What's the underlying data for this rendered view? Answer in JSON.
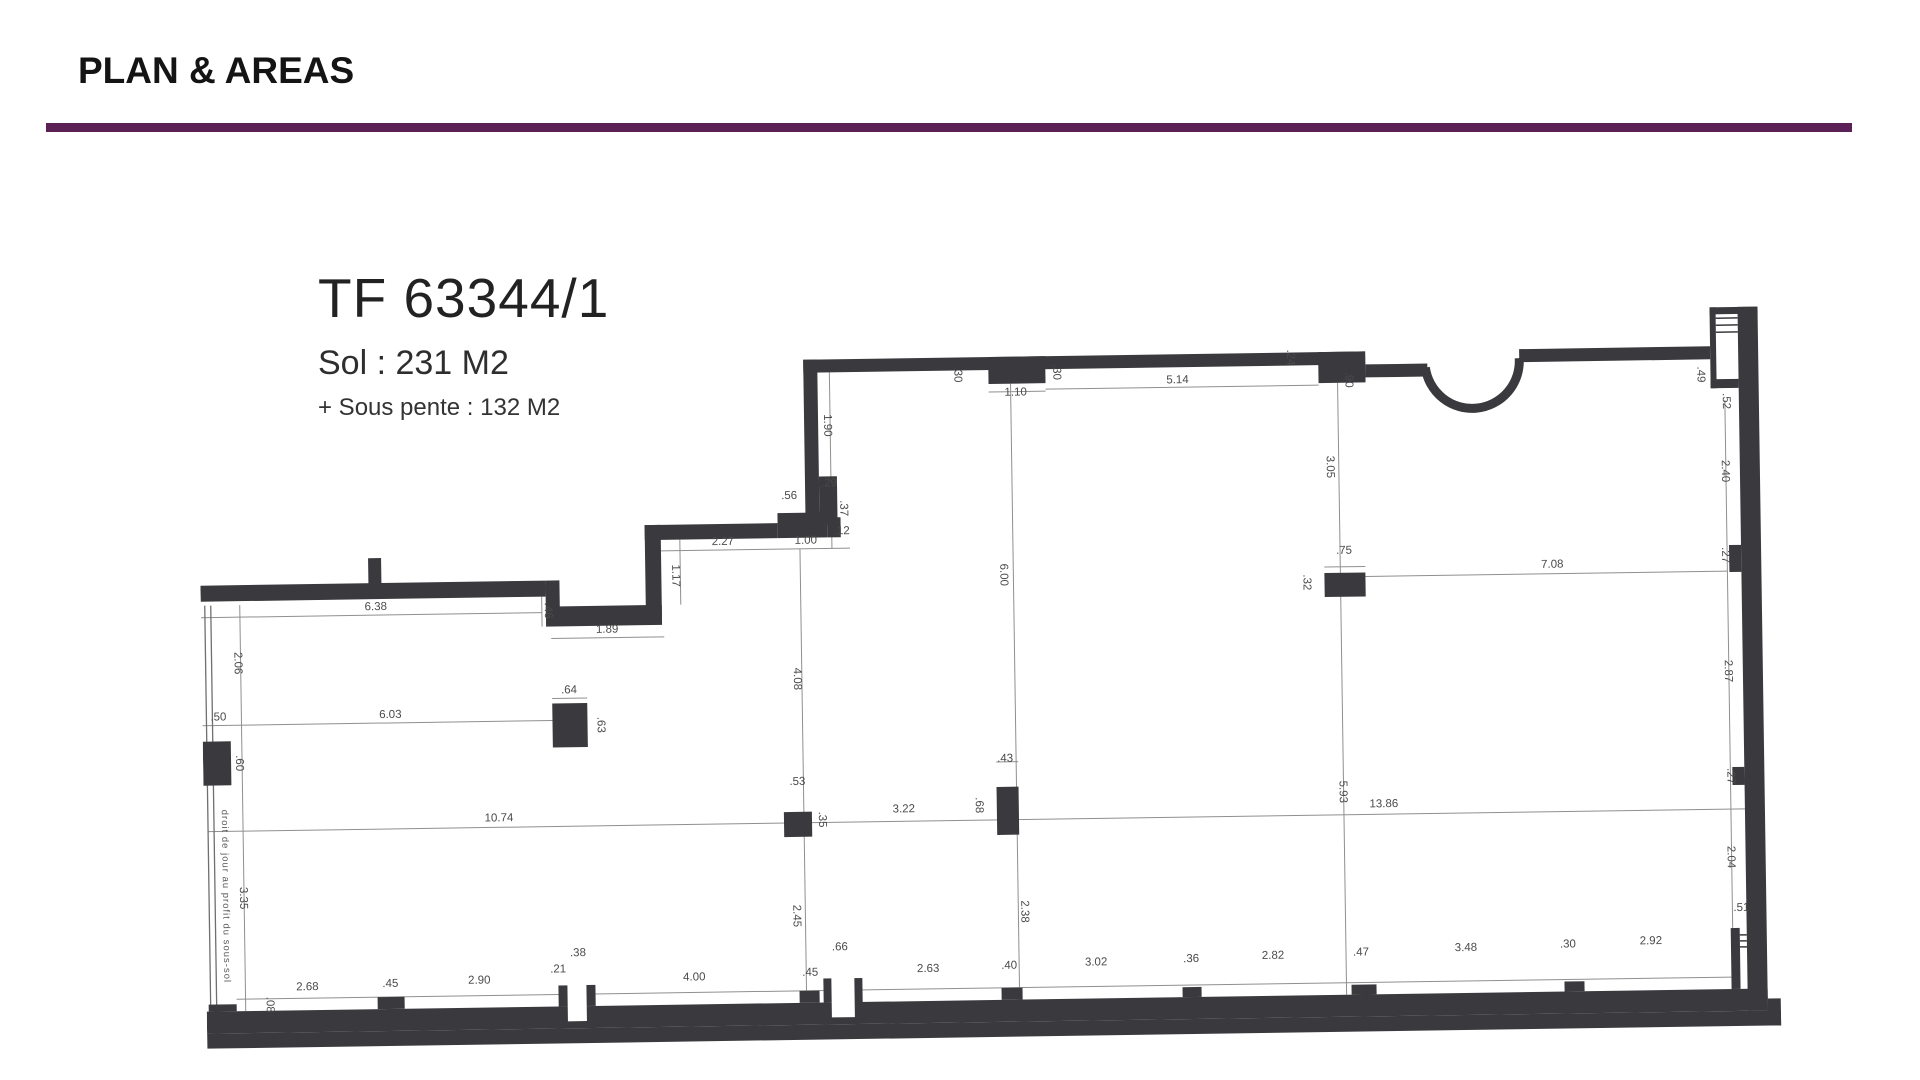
{
  "page": {
    "title": "PLAN & AREAS",
    "accent_color": "#5b2157",
    "background": "#ffffff"
  },
  "plan": {
    "title": "TF 63344/1",
    "area_sol": "Sol : 231 M2",
    "area_sous_pente": "+ Sous pente : 132 M2",
    "boundary_note": "droit de jour au profit du sous-sol",
    "ink_color": "#3a3a3e",
    "dim_line_color": "#8f8f8f",
    "dim_text_color": "#4a4a4a",
    "dimensions": [
      {
        "t": "6.38",
        "x": 175,
        "y": 301,
        "r": 0
      },
      {
        "t": ".46",
        "x": 344,
        "y": 304,
        "r": 90
      },
      {
        "t": "1.89",
        "x": 406,
        "y": 327,
        "r": 0
      },
      {
        "t": "2.06",
        "x": 33,
        "y": 352,
        "r": 90
      },
      {
        "t": ".50",
        "x": 16,
        "y": 409,
        "r": 0
      },
      {
        "t": "6.03",
        "x": 188,
        "y": 409,
        "r": 0
      },
      {
        "t": ".64",
        "x": 367,
        "y": 387,
        "r": 0
      },
      {
        "t": ".63",
        "x": 395,
        "y": 419,
        "r": 90
      },
      {
        "t": ".60",
        "x": 33,
        "y": 452,
        "r": 90
      },
      {
        "t": "3.35",
        "x": 35,
        "y": 587,
        "r": 90
      },
      {
        "t": ".08",
        "x": 60,
        "y": 694,
        "r": 90
      },
      {
        "t": "1.90",
        "x": 626,
        "y": 123,
        "r": 90
      },
      {
        "t": ".29",
        "x": 630,
        "y": 184,
        "r": 0
      },
      {
        "t": ".37",
        "x": 641,
        "y": 206,
        "r": 90
      },
      {
        "t": ".56",
        "x": 590,
        "y": 196,
        "r": 0
      },
      {
        "t": "2.27",
        "x": 523,
        "y": 241,
        "r": 0
      },
      {
        "t": "1.00",
        "x": 606,
        "y": 241,
        "r": 0
      },
      {
        "t": ".12",
        "x": 642,
        "y": 232,
        "r": 0
      },
      {
        "t": "1.17",
        "x": 472,
        "y": 271,
        "r": 90
      },
      {
        "t": ".30",
        "x": 757,
        "y": 74,
        "r": 90
      },
      {
        "t": "1.10",
        "x": 818,
        "y": 96,
        "r": 0
      },
      {
        "t": ".30",
        "x": 856,
        "y": 73,
        "r": 90
      },
      {
        "t": "5.14",
        "x": 980,
        "y": 86,
        "r": 0
      },
      {
        "t": ".24",
        "x": 1090,
        "y": 62,
        "r": 90
      },
      {
        "t": ".90",
        "x": 1148,
        "y": 85,
        "r": 90
      },
      {
        "t": ".49",
        "x": 1500,
        "y": 85,
        "r": 90
      },
      {
        "t": ".52",
        "x": 1525,
        "y": 112,
        "r": 90
      },
      {
        "t": "2.40",
        "x": 1523,
        "y": 182,
        "r": 90
      },
      {
        "t": ".27",
        "x": 1522,
        "y": 266,
        "r": 90
      },
      {
        "t": "2.87",
        "x": 1523,
        "y": 382,
        "r": 90
      },
      {
        "t": ".27",
        "x": 1524,
        "y": 487,
        "r": 90
      },
      {
        "t": "2.04",
        "x": 1523,
        "y": 568,
        "r": 90
      },
      {
        "t": ".51",
        "x": 1536,
        "y": 622,
        "r": 0
      },
      {
        "t": "4.08",
        "x": 592,
        "y": 376,
        "r": 90
      },
      {
        "t": ".53",
        "x": 594,
        "y": 482,
        "r": 0
      },
      {
        "t": ".35",
        "x": 615,
        "y": 517,
        "r": 90
      },
      {
        "t": "10.74",
        "x": 295,
        "y": 514,
        "r": 0
      },
      {
        "t": "3.22",
        "x": 700,
        "y": 511,
        "r": 0
      },
      {
        "t": ".43",
        "x": 802,
        "y": 462,
        "r": 0
      },
      {
        "t": ".68",
        "x": 772,
        "y": 505,
        "r": 90
      },
      {
        "t": "6.00",
        "x": 800,
        "y": 275,
        "r": 90
      },
      {
        "t": "2.45",
        "x": 588,
        "y": 613,
        "r": 90
      },
      {
        "t": "2.38",
        "x": 816,
        "y": 612,
        "r": 90
      },
      {
        "t": "3.05",
        "x": 1128,
        "y": 172,
        "r": 90
      },
      {
        "t": ".75",
        "x": 1144,
        "y": 259,
        "r": 0
      },
      {
        "t": ".32",
        "x": 1103,
        "y": 287,
        "r": 90
      },
      {
        "t": "7.08",
        "x": 1352,
        "y": 276,
        "r": 0
      },
      {
        "t": "5.93",
        "x": 1136,
        "y": 497,
        "r": 90
      },
      {
        "t": "13.86",
        "x": 1180,
        "y": 513,
        "r": 0
      },
      {
        "t": "2.68",
        "x": 101,
        "y": 680,
        "r": 0
      },
      {
        "t": ".45",
        "x": 184,
        "y": 678,
        "r": 0
      },
      {
        "t": "2.90",
        "x": 273,
        "y": 676,
        "r": 0
      },
      {
        "t": ".21",
        "x": 352,
        "y": 666,
        "r": 0
      },
      {
        "t": ".38",
        "x": 372,
        "y": 650,
        "r": 0
      },
      {
        "t": "4.00",
        "x": 488,
        "y": 676,
        "r": 0
      },
      {
        "t": ".45",
        "x": 604,
        "y": 673,
        "r": 0
      },
      {
        "t": ".66",
        "x": 634,
        "y": 648,
        "r": 0
      },
      {
        "t": "2.63",
        "x": 722,
        "y": 671,
        "r": 0
      },
      {
        "t": ".40",
        "x": 803,
        "y": 669,
        "r": 0
      },
      {
        "t": "3.02",
        "x": 890,
        "y": 667,
        "r": 0
      },
      {
        "t": ".36",
        "x": 985,
        "y": 665,
        "r": 0
      },
      {
        "t": "2.82",
        "x": 1067,
        "y": 663,
        "r": 0
      },
      {
        "t": ".47",
        "x": 1155,
        "y": 661,
        "r": 0
      },
      {
        "t": "3.48",
        "x": 1260,
        "y": 658,
        "r": 0
      },
      {
        "t": ".30",
        "x": 1362,
        "y": 656,
        "r": 0
      },
      {
        "t": "2.92",
        "x": 1445,
        "y": 654,
        "r": 0
      }
    ]
  }
}
